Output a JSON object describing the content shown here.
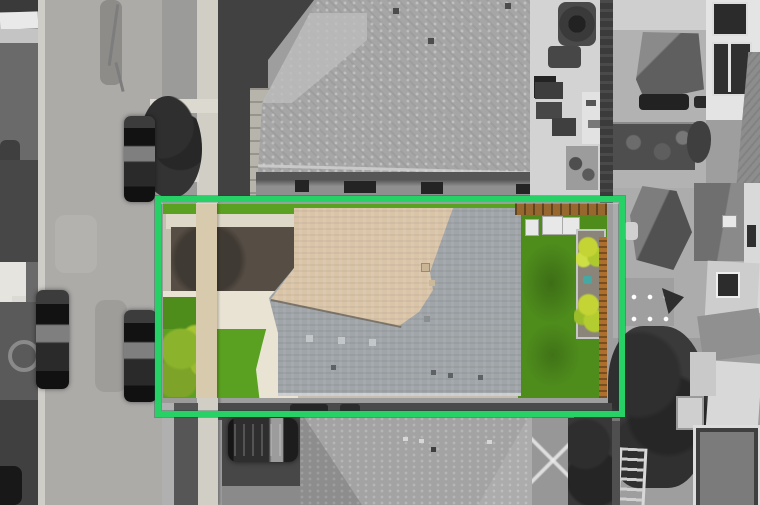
{
  "scene": {
    "kind": "aerial-drone-photo",
    "description": "Top-down aerial photograph of a suburban lot. The highlighted property (inside a bright green boundary box) is shown in full color: tan and gray shingled roof, dark asphalt driveway, concrete walkways, bright front lawn with shrubs, fenced backyard lawn with raised garden beds. Everything outside the box is desaturated grayscale: street with parked cars on the left, neighboring roofs above and below, patios, sheds, trees and yards to the right.",
    "labels": {
      "photo": "aerial property photo",
      "highlight": "highlighted property boundary",
      "property": "subject property (in color)",
      "street": "street with parked cars",
      "top_neighbor": "neighboring house roof (top)",
      "bottom_neighbor": "neighboring house roof (bottom)",
      "right_neighbors": "neighboring yards and houses (right)",
      "patio": "neighbor patio with furniture",
      "backyard": "backyard lawn with garden beds",
      "driveway": "asphalt driveway",
      "sidewalk": "concrete sidewalk",
      "parked_car": "parked car",
      "suv": "parked SUV",
      "tree": "tree canopy",
      "garden": "raised garden beds",
      "fence": "wood fence"
    }
  },
  "colors": {
    "gray-bg": "#9e9e9e",
    "highlight": "#28d166",
    "road": "#adaba8",
    "curb": "#cfcdc8",
    "sidewalk": "#d1cec6",
    "top-roof": "#a6a6a6",
    "top-roof-light": "#bdbdbd",
    "wall": "#8f8f8f",
    "window-dark": "#242424",
    "patio": "#d3d3d3",
    "hedge": "#3b3b3b",
    "yard-gray": "#b2b2b2",
    "pyramid-dark": "#5f5f5f",
    "white-wall": "#e4e4e4",
    "gazebo": "#515151",
    "shed-gray": "#9f9f9f",
    "foliage": "#3a3a3a",
    "bottom-roof": "#a3a3a3",
    "trailer-gray": "#7b7b7b",
    "dark-band": "#4a4a4a",
    "lawn": "#4e8c1c",
    "lawn-bright": "#5aa021",
    "bush": "#8cb32c",
    "plants": "#c3d434",
    "roof-tan": "#d9c4a8",
    "roof-gray": "#a0a5a9",
    "drive-dark": "#564e45",
    "tan-walk": "#d7caad",
    "cream": "#e9e3d3",
    "fence": "#ad6f2d",
    "garden-frame": "#c6c6c6",
    "soil": "#8b8478",
    "teal": "#45a8a2",
    "pergola": "#96682f",
    "white-box": "#e8e8e8"
  }
}
